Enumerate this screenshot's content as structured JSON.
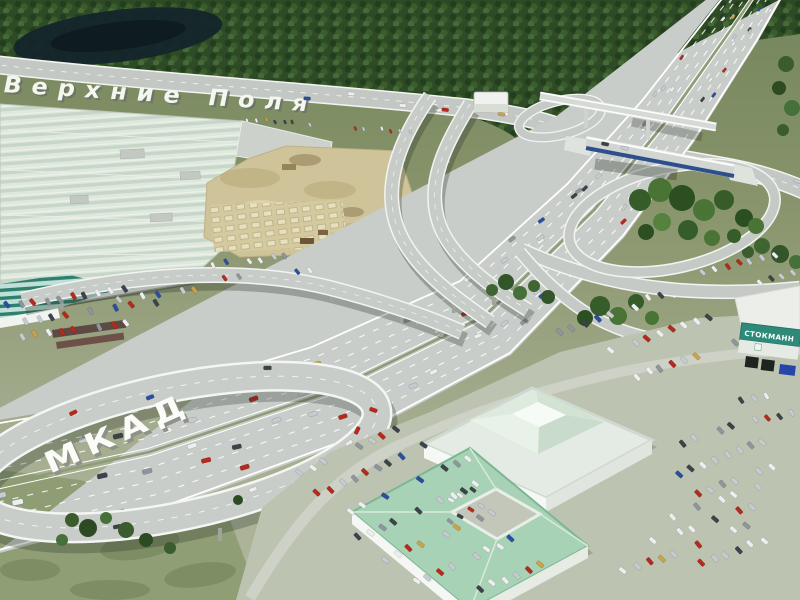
{
  "scene": {
    "description": "Aerial 3D architectural rendering of a MKAD ring-road interchange with looping ramps, a blue overpass bridge, shopping-mall buildings, a construction site and car-filled parking lots",
    "labels": {
      "road_surface_letters": "МКАД",
      "street_name_letters": "Верхние Поля",
      "store_sign": "СТОКМАНН"
    },
    "colors": {
      "forest": "#2e4a26",
      "pond": "#14252a",
      "grass_top": "#74855c",
      "grass_bottom": "#b0b79c",
      "road": "#c9cdc9",
      "road_edge": "#ffffff",
      "bridge_girder_blue": "#2d4f8c",
      "construction_sand": "#d2c79b",
      "mall_roof_light": "#dfe8dd",
      "teal_roof_stripe": "#2e7f6d",
      "green_roof": "#a8d2b6",
      "sign_teal": "#2e8a78"
    },
    "cars": {
      "palette": [
        "#eceeef",
        "#c6cbd1",
        "#8f959d",
        "#3d434a",
        "#b42a1e",
        "#2a4fa0",
        "#c9a24a"
      ],
      "weights": [
        0.3,
        0.22,
        0.12,
        0.12,
        0.15,
        0.06,
        0.03
      ]
    }
  }
}
